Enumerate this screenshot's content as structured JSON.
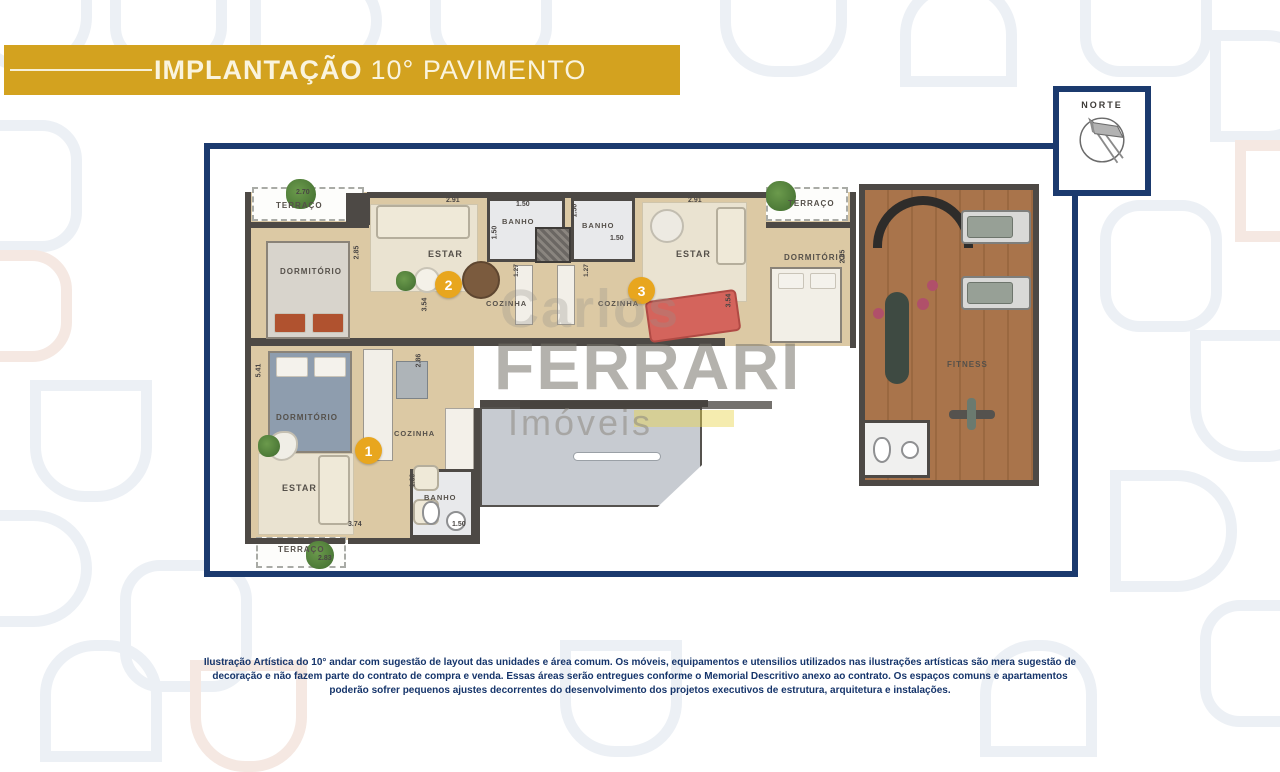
{
  "banner": {
    "title_bold": "IMPLANTAÇÃO",
    "title_light": "10° PAVIMENTO"
  },
  "compass": {
    "label": "NORTE"
  },
  "colors": {
    "gold": "#D3A21F",
    "navy": "#1B3A6E",
    "badge_gold": "#E8A61E"
  },
  "watermark": {
    "carlos": "Carlos",
    "ferrari": "FERRARI",
    "imoveis": "Imóveis"
  },
  "plan": {
    "unit1": {
      "badge": "1",
      "dormitorio": "DORMITÓRIO",
      "estar": "ESTAR",
      "cozinha": "COZINHA",
      "banho": "BANHO",
      "terraco": "TERRAÇO",
      "dims": {
        "d541": "5.41",
        "d286": "2.86",
        "d160": "1.60",
        "d150": "1.50",
        "d374": "3.74",
        "d283": "2.83"
      }
    },
    "unit2": {
      "badge": "2",
      "terraco": "TERRAÇO",
      "dormitorio": "DORMITÓRIO",
      "estar": "ESTAR",
      "cozinha": "COZINHA",
      "banho": "BANHO",
      "dims": {
        "d270": "2.70",
        "d291": "2.91",
        "d285": "2.85",
        "d354": "3.54",
        "d150a": "1.50",
        "d150b": "1.50",
        "d127": "1.27"
      }
    },
    "unit3": {
      "badge": "3",
      "terraco": "TERRAÇO",
      "dormitorio": "DORMITÓRIO",
      "estar": "ESTAR",
      "cozinha": "COZINHA",
      "banho": "BANHO",
      "dims": {
        "d291": "2.91",
        "d285": "2.85",
        "d354": "3.54",
        "d150a": "1.50",
        "d150b": "1.50",
        "d127": "1.27"
      }
    },
    "common": {
      "fitness": "FITNESS"
    }
  },
  "footer": {
    "disclaimer": "Ilustração Artística do  10°  andar com sugestão de layout das unidades e área comum. Os móveis, equipamentos e utensilios utilizados nas ilustrações artísticas são mera sugestão de decoração e não fazem parte do contrato de compra e venda. Essas áreas serão entregues conforme o Memorial Descritivo anexo ao contrato. Os espaços comuns e apartamentos poderão sofrer pequenos ajustes decorrentes do desenvolvimento dos projetos executivos de estrutura, arquitetura e instalações."
  }
}
